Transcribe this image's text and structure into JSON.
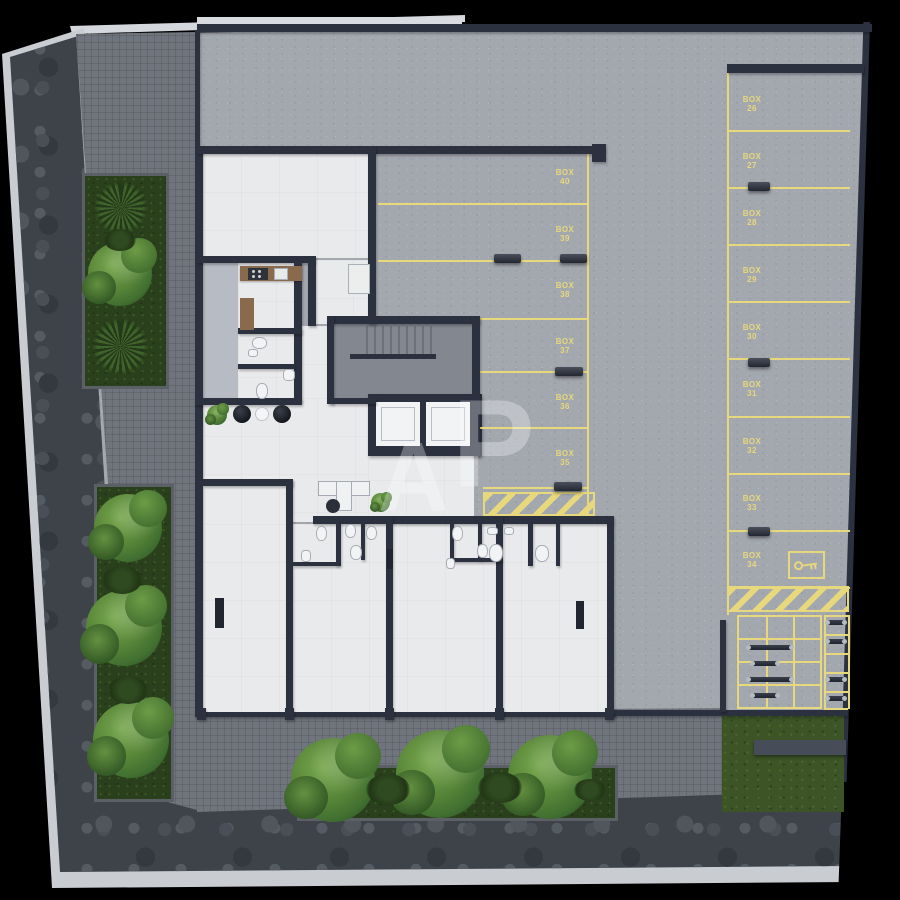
{
  "watermark": {
    "a": "A",
    "p": "P"
  },
  "parking": {
    "middle_column": {
      "boxes": [
        {
          "label": "BOX",
          "number": "40"
        },
        {
          "label": "BOX",
          "number": "39"
        },
        {
          "label": "BOX",
          "number": "38"
        },
        {
          "label": "BOX",
          "number": "37"
        },
        {
          "label": "BOX",
          "number": "36"
        },
        {
          "label": "BOX",
          "number": "35"
        }
      ]
    },
    "right_column": {
      "boxes": [
        {
          "label": "BOX",
          "number": "26"
        },
        {
          "label": "BOX",
          "number": "27"
        },
        {
          "label": "BOX",
          "number": "28"
        },
        {
          "label": "BOX",
          "number": "29"
        },
        {
          "label": "BOX",
          "number": "30"
        },
        {
          "label": "BOX",
          "number": "31"
        },
        {
          "label": "BOX",
          "number": "32"
        },
        {
          "label": "BOX",
          "number": "33"
        },
        {
          "label": "BOX",
          "number": "34"
        }
      ]
    }
  },
  "colors": {
    "marking_yellow": "#e7d77d",
    "wall": "#2c3140",
    "pavement": "#a3a7ae",
    "sidewalk": "#70747c",
    "grass_green": "#3c5426",
    "floor_white": "#e9eaec"
  }
}
